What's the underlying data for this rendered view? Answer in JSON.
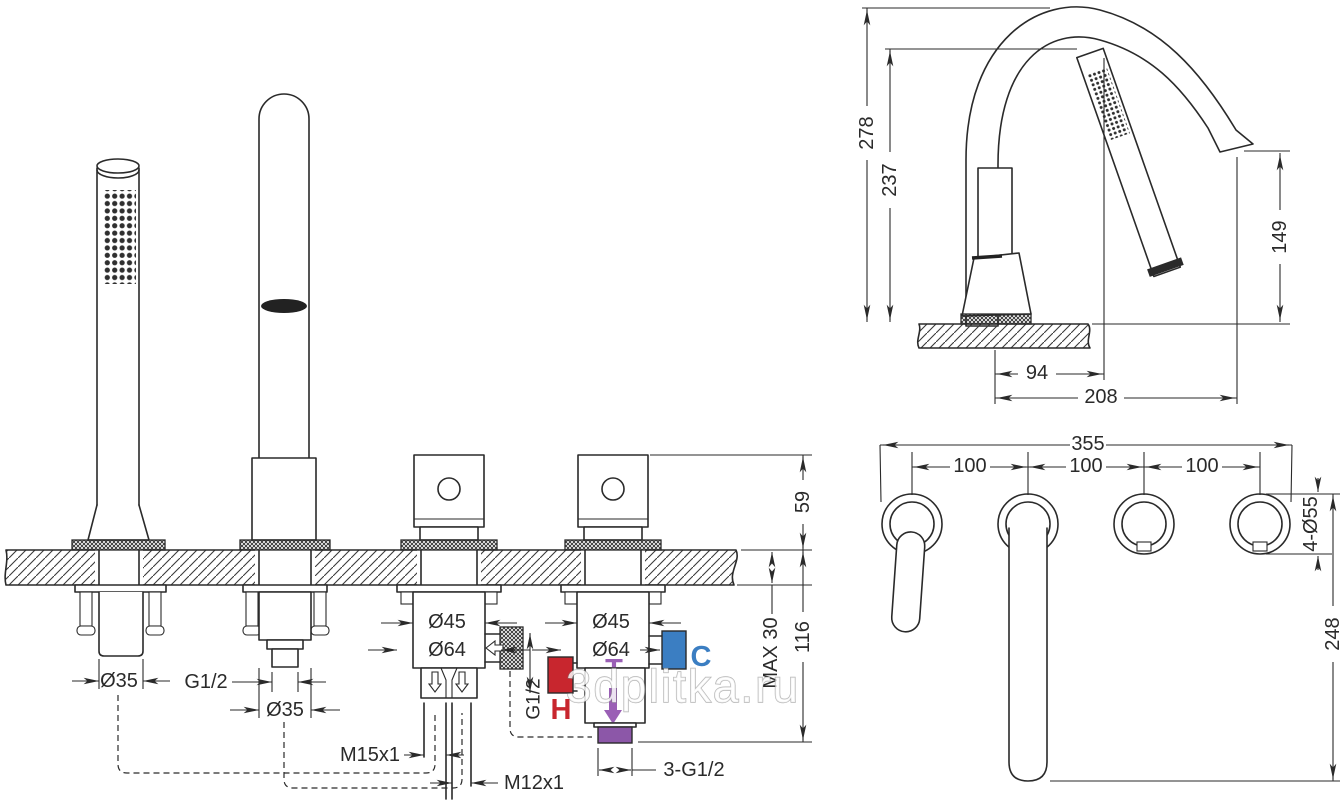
{
  "watermark": "3dplitka.ru",
  "colors": {
    "line": "#2a2a2a",
    "hot": "#c8262e",
    "cold": "#3b7ec2",
    "mix": "#9a5fb5",
    "mix_block": "#8c57a8"
  },
  "front": {
    "shower_dia": "Ø35",
    "spout_thread": "G1/2",
    "spout_dia": "Ø35",
    "valve_left_d45": "Ø45",
    "valve_left_d64": "Ø64",
    "valve_left_side_thread": "G1/2",
    "valve_right_d45": "Ø45",
    "valve_right_d64": "Ø64",
    "hot": "H",
    "cold": "C",
    "mix": "T",
    "hose_thread": "M15x1",
    "pipe_thread": "M12x1",
    "outlet_thread": "3-G1/2",
    "deck_max": "MAX 30",
    "dim_above_deck": "59",
    "dim_below_deck": "116"
  },
  "side": {
    "dim_total_height": "278",
    "dim_shower_height": "237",
    "dim_spout_height": "149",
    "dim_shower_reach": "94",
    "dim_spout_reach": "208"
  },
  "top": {
    "dim_total_width": "355",
    "dim_spacing_1": "100",
    "dim_spacing_2": "100",
    "dim_spacing_3": "100",
    "dim_holes": "4-Ø55",
    "dim_reach": "248"
  }
}
